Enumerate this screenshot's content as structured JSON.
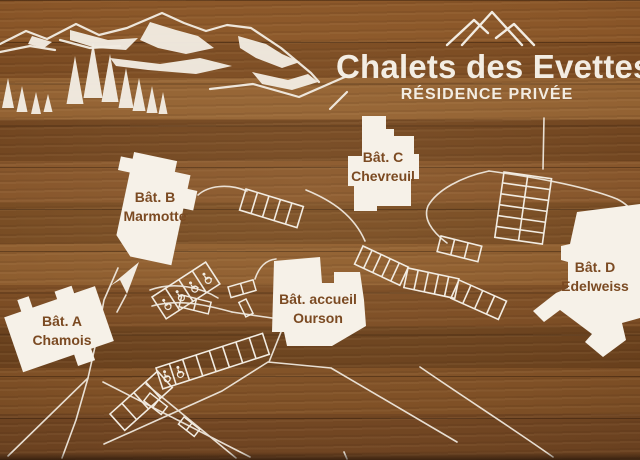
{
  "sign": {
    "title": "Chalets des Evettes",
    "subtitle": "RÉSIDENCE PRIVÉE"
  },
  "buildings": {
    "a": {
      "name": "Bât. A",
      "subname": "Chamois"
    },
    "b": {
      "name": "Bât. B",
      "subname": "Marmotte"
    },
    "c": {
      "name": "Bât. C",
      "subname": "Chevreuil"
    },
    "accueil": {
      "name": "Bât. accueil",
      "subname": "Ourson"
    },
    "d": {
      "name": "Bât. D",
      "subname": "Edelweiss"
    }
  },
  "icons": {
    "mountain_logo": "three-peak mountain outline",
    "mountain_art": "mountain ridge with snow and pine trees",
    "accessible_parking": "wheelchair symbol"
  },
  "colors": {
    "wood_brown": "#7b4a22",
    "line_white": "#f2ece2",
    "label_brown": "#7b4a22"
  }
}
